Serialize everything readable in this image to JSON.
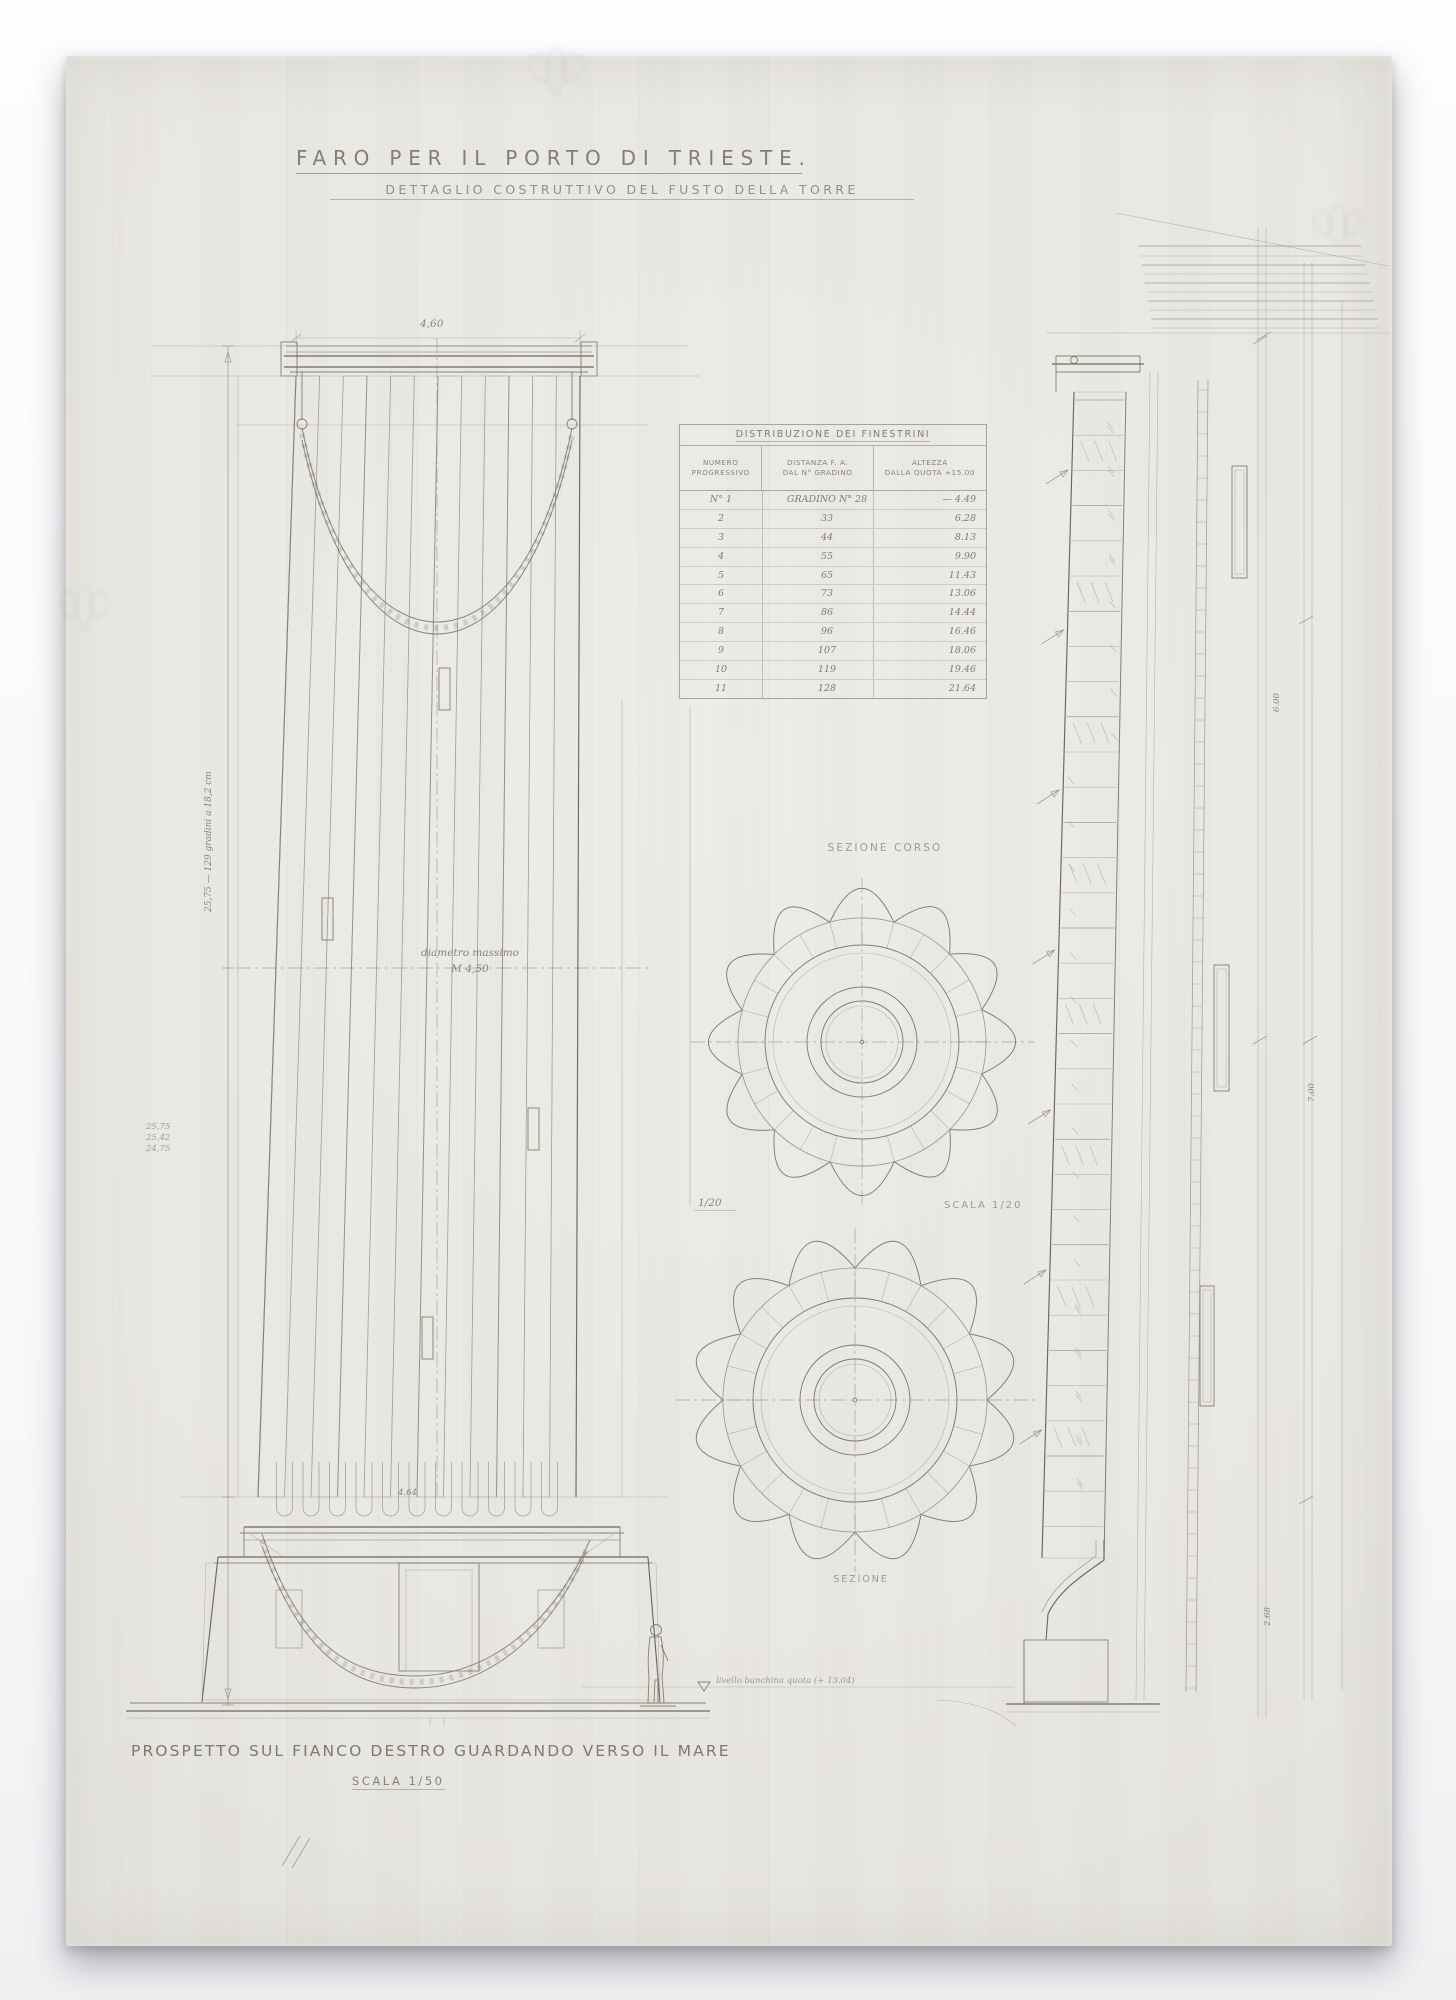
{
  "drawing": {
    "title": "FARO PER IL PORTO DI TRIESTE.",
    "subtitle": "DETTAGLIO COSTRUTTIVO DEL FUSTO DELLA TORRE"
  },
  "elevation": {
    "top_width": "4,60",
    "diameter_note_line1": "diametro massimo",
    "diameter_note_line2": "M 4,50",
    "base_width": "4.64",
    "steps_note": "25,75 — 129 gradini a 18,2 cm",
    "margin_numbers": [
      "25,75",
      "25,42",
      "24,75"
    ],
    "sea_level_note": "livello banchina quota (+ 13.04)",
    "caption": "PROSPETTO SUL FIANCO DESTRO GUARDANDO VERSO IL MARE",
    "caption_scale": "SCALA 1/50"
  },
  "windows_table": {
    "title": "DISTRIBUZIONE DEI FINESTRINI",
    "columns": [
      {
        "line1": "NUMERO",
        "line2": "PROGRESSIVO"
      },
      {
        "line1": "DISTANZA F. A.",
        "line2": "DAL N° GRADINO"
      },
      {
        "line1": "ALTEZZA",
        "line2": "DALLA QUOTA +15.00"
      }
    ],
    "rows": [
      [
        "N° 1",
        "GRADINO N° 28",
        "— 4.49"
      ],
      [
        "2",
        "33",
        "6.28"
      ],
      [
        "3",
        "44",
        "8.13"
      ],
      [
        "4",
        "55",
        "9.90"
      ],
      [
        "5",
        "65",
        "11.43"
      ],
      [
        "6",
        "73",
        "13.06"
      ],
      [
        "7",
        "86",
        "14.44"
      ],
      [
        "8",
        "96",
        "16.46"
      ],
      [
        "9",
        "107",
        "18.06"
      ],
      [
        "10",
        "119",
        "19.46"
      ],
      [
        "11",
        "128",
        "21.64"
      ]
    ]
  },
  "plan_sections": {
    "upper_label": "SEZIONE CORSO",
    "scale_left": "1/20",
    "scale_right": "SCALA 1/20",
    "lower_label": "SEZIONE"
  },
  "wall_section": {
    "dim_top": "6.00",
    "dim_mid": "7.00",
    "dim_bottom": "2.68"
  },
  "colors": {
    "paper": "#e9e7e2",
    "pencil": "#6d6a5a",
    "pencil_light": "#98958a",
    "figure_dark": "#524f46"
  }
}
